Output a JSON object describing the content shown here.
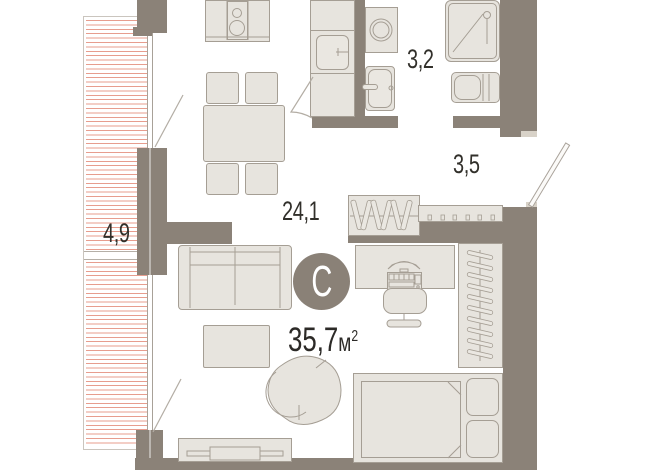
{
  "plan": {
    "unit_badge": {
      "label": "С"
    },
    "total": {
      "value": "35,7",
      "unit": "м",
      "sup": "2"
    },
    "areas": {
      "living": "24,1",
      "bathroom": "3,2",
      "hallway": "3,5",
      "balcony": "4,9"
    },
    "colors": {
      "wall": "#8b8278",
      "furniture_fill": "#e7e4de",
      "furniture_stroke": "#a59e94",
      "balcony_hatch": "#e79d8e",
      "label_text": "#32302b",
      "badge_fill": "#8a8177",
      "badge_text": "#ffffff"
    }
  }
}
